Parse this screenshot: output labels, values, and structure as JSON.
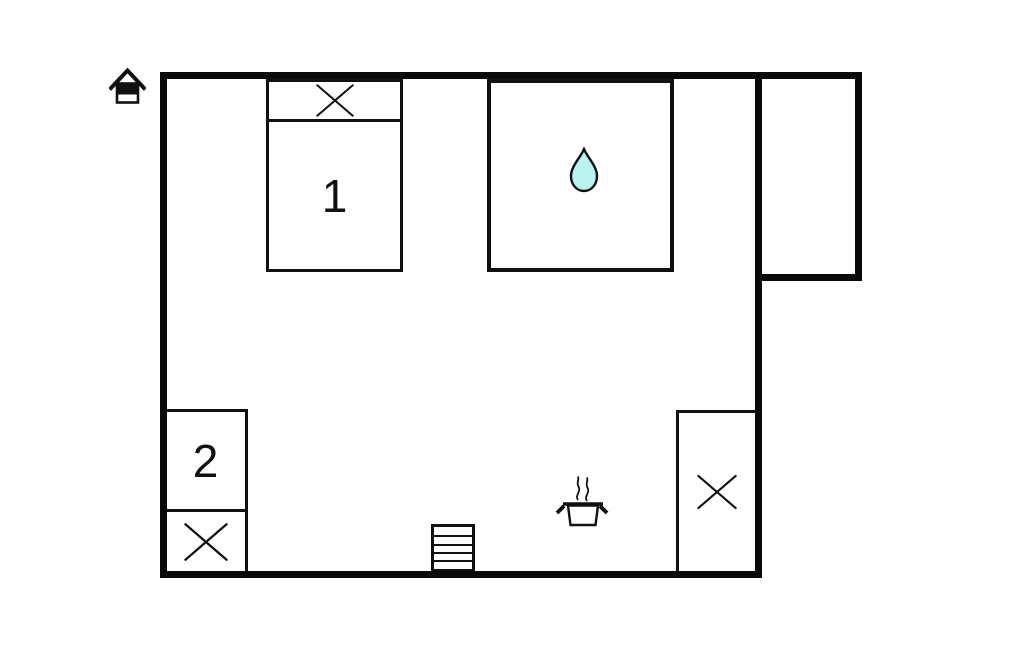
{
  "floorplan": {
    "background_color": "#ffffff",
    "line_color": "#0a0a0a",
    "water_drop_color": "#b9f2ef",
    "bedroom1": {
      "label": "1"
    },
    "bedroom2": {
      "label": "2"
    },
    "icons": [
      "home-icon",
      "cross-icon-bed1-head",
      "water-drop-icon",
      "cross-icon-bed2",
      "cross-icon-closet",
      "stairs-icon",
      "cooking-pot-icon"
    ]
  }
}
